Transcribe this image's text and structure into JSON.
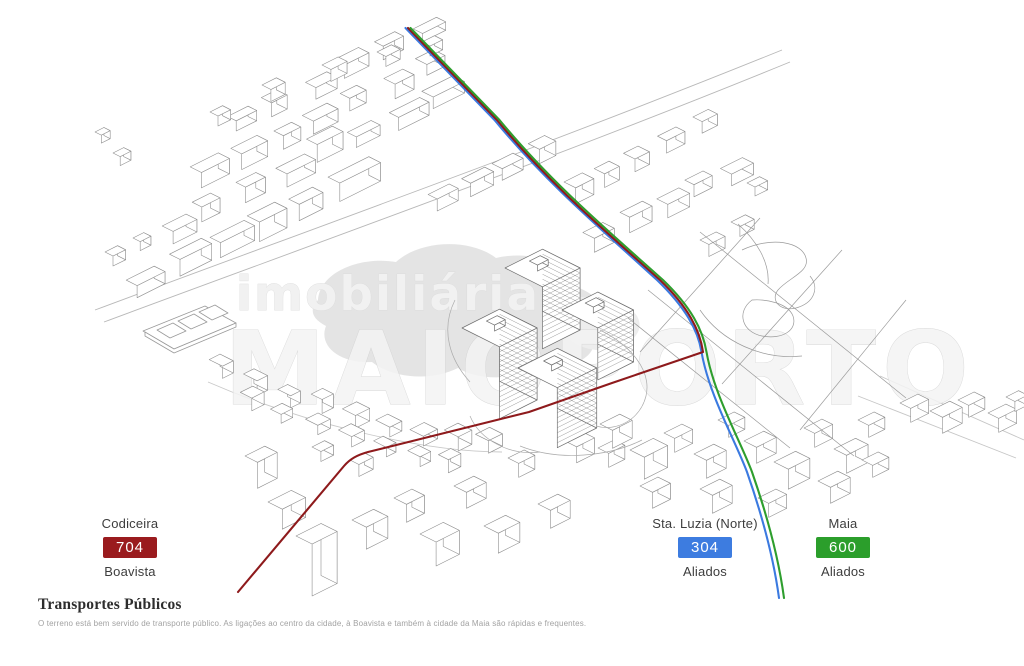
{
  "watermark": {
    "line1": "imobiliária",
    "line2": "MAIOPORTO"
  },
  "stops": [
    {
      "name": "Codiceira",
      "line_number": "704",
      "destination": "Boavista",
      "color": "#9a1b1e"
    },
    {
      "name": "Sta. Luzia (Norte)",
      "line_number": "304",
      "destination": "Aliados",
      "color": "#3d7ce0"
    },
    {
      "name": "Maia",
      "line_number": "600",
      "destination": "Aliados",
      "color": "#2b9e2b"
    }
  ],
  "routes": [
    {
      "name": "704",
      "color": "#8e1a1c"
    },
    {
      "name": "304",
      "color": "#3b7ae0"
    },
    {
      "name": "600",
      "color": "#2e9e2e"
    }
  ],
  "footer": {
    "title": "Transportes Públicos",
    "description": "O terreno está bem servido de transporte público. As ligações ao centro da cidade, à Boavista e também à cidade da Maia são rápidas e frequentes."
  }
}
